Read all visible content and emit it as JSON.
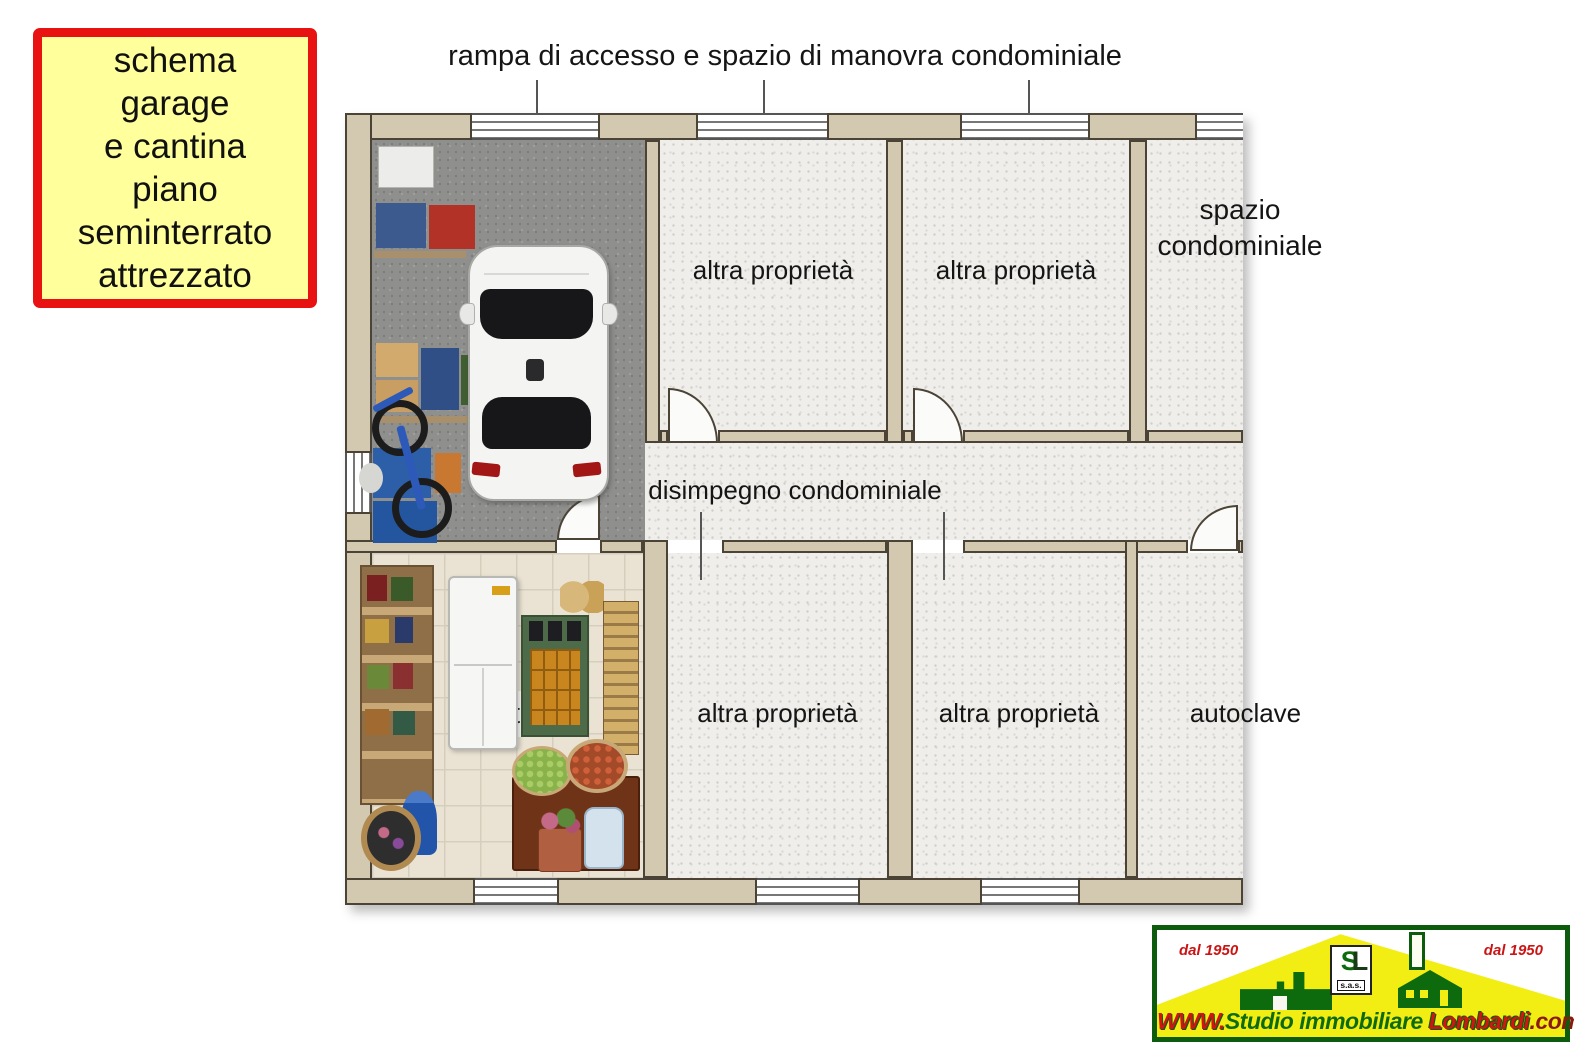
{
  "title_box": {
    "lines": [
      "schema",
      "garage",
      "e cantina",
      "piano",
      "seminterrato",
      "attrezzato"
    ]
  },
  "plan": {
    "ramp_label": "rampa di accesso e spazio di manovra condominiale",
    "corridor_label": "disimpegno condominiale",
    "rooms": {
      "top_room_1": "altra proprietà",
      "top_room_2": "altra proprietà",
      "spazio_line_1": "spazio",
      "spazio_line_2": "condominiale",
      "bottom_room_1": "altra proprietà",
      "bottom_room_2": "altra proprietà",
      "autoclave": "autoclave",
      "cantina": "cantina"
    }
  },
  "logo": {
    "since_left": "dal 1950",
    "since_right": "dal 1950",
    "monogram_s": "S",
    "monogram_l": "L",
    "sas": "s.a.s.",
    "website": {
      "www": "WWW.",
      "studio": "Studio immobiliare ",
      "lombardi": "Lombardi",
      "com": ".com"
    }
  },
  "colors": {
    "title_box_bg": "#FFFF9C",
    "title_box_border": "#E91212",
    "wall_fill": "#D3C8B0",
    "garage_floor": "#8F8F8D",
    "room_floor": "#EFEEEA",
    "logo_green": "#0D6B0D",
    "logo_yellow": "#F2EE14",
    "logo_red": "#D11414"
  }
}
